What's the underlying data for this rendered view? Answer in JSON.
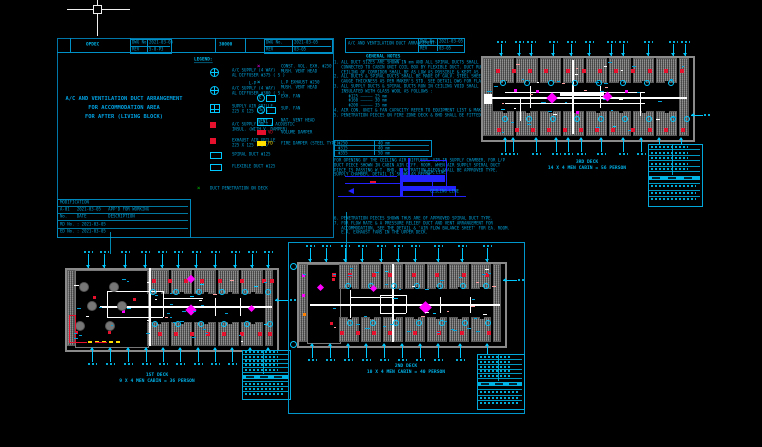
{
  "app": {
    "cursor": {
      "x": 97,
      "y": 9
    }
  },
  "colors": {
    "background": "#000000",
    "cyan_text": "#00A0D8",
    "cyan_marker": "#00C8FF",
    "red": "#E8112D",
    "magenta": "#FF00FF",
    "orange": "#FF8000",
    "green": "#00C800",
    "yellow": "#FFE000",
    "blue_detail": "#2222FF",
    "wall_gray": "#7E7E7E",
    "duct_white": "#FFFFFF"
  },
  "sheet1": {
    "header": {
      "org_label": "OPDEC",
      "code": "30000",
      "t1": {
        "dwg_label": "DWG No.",
        "dwg_value": "2021-03-05",
        "rev_label": "REV",
        "rev_value": "5-0-P3"
      },
      "t2": {
        "dwg_label": "DWG No.",
        "dwg_value": "2021-03-05",
        "rev_label": "REV",
        "rev_value": "03-05"
      }
    },
    "title_lines": [
      "A/C AND VENTILATION DUCT ARRANGEMENT",
      "FOR ACCOMMODATION AREA",
      "FOR AFTER (LIVING BLOCK)"
    ],
    "revision": {
      "rows": [
        "MODIFICATION",
        "A-01   2021-03-05   APP'D FOR WORKING",
        "No.    DATE         DESCRIPTION",
        "RD No. : 2021-03-05",
        "ED No. : 2021-03-05"
      ]
    }
  },
  "sheet2_header": {
    "title": "A/C AND VENTILATION DUCT ARRANGEMENT",
    "dwg_label": "DWG No.",
    "dwg_value": "2021-03-05",
    "rev_label": "REV",
    "rev_value": "03-05"
  },
  "legend": {
    "heading": "LEGEND:",
    "left": [
      {
        "icon": "diffuser-4way",
        "lines": [
          "A/C SUPPLY (4 WAY)",
          "AL DIFFUSER Φ375 ( S )"
        ]
      },
      {
        "icon": "diffuser-4way",
        "lines": [
          "A/C SUPPLY (4 WAY)",
          "AL DIFFUSER Φ300 ( S )"
        ]
      },
      {
        "icon": "grille",
        "lines": [
          "SUPPLY AIR GRILLE",
          "225 X 125 ( S )"
        ]
      },
      {
        "icon": "red-square",
        "lines": [
          "A/C SUPPLY DUCT / ACOUSTIC",
          "INSUL. (WITH V. DAMPER)"
        ]
      },
      {
        "icon": "red-square",
        "lines": [
          "EXHAUST AIR GRILLE",
          "225 X 125 ( E )"
        ]
      },
      {
        "icon": "duct-box",
        "lines": [
          "SPIRAL DUCT Φ125"
        ]
      },
      {
        "icon": "duct-box",
        "lines": [
          "FLEXIBLE DUCT Φ125"
        ]
      }
    ],
    "right": [
      {
        "icon": "magenta-x",
        "lines": [
          "CONST. VOL. EXH. Φ250",
          "MUSH. VENT HEAD"
        ]
      },
      {
        "icon": "cyan-x",
        "label": "L-P",
        "lines": [
          "L.P EXHAUST Φ250",
          "MUSH. VENT HEAD"
        ]
      },
      {
        "icon": "circle-e",
        "label": "E",
        "lines": [
          "EXH. FAN"
        ]
      },
      {
        "icon": "circle-s",
        "label": "S",
        "lines": [
          "SUP. FAN"
        ]
      },
      {
        "icon": "vent-box",
        "label": "VENT",
        "lines": [
          "NAT. VENT HEAD"
        ]
      },
      {
        "icon": "vd-box",
        "label": "VD",
        "lines": [
          "VOLUME DAMPER"
        ]
      },
      {
        "icon": "fd-box",
        "label": "FD",
        "lines": [
          "FIRE DAMPER (STEEL TYPE)"
        ]
      }
    ],
    "bottom": {
      "icon": "green-x",
      "lines": [
        "DUCT PENETRATION ON DECK"
      ]
    }
  },
  "notes": {
    "heading": "GENERAL NOTES",
    "lines": [
      "1. ALL DUCT SIZES ARE SHOWN IN mm AND ALL SPIRAL DUCTS SHALL BE 'Y' d",
      "   CONNECTED TO CABIN UNIT COIL BOX BY FLEXIBLE DUCT. DUCT RUN IN",
      "   CEILING OF CORRIDOR SHALL BE AS LOW AS POSSIBLE & KEPT AS SHOWN.",
      "2. ALL DUCTS & SPIRAL DUCTS SHALL BE MADE OF GALV. STEEL SHEET AND",
      "   GAUGE THICKNESS AS PER MAKER'S STD. SEE DETAIL DWG FOR FLANGE.",
      "3. ALL SUPPLY DUCTS & SPIRAL DUCTS RUN IN CEILING VOID SHALL BE",
      "   INSULATED WITH GLASS WOOL AS FOLLOWS :",
      "      Φ125 ————— 25 mm",
      "      Φ160 ————— 30 mm",
      "      Φ200 ————— 35 mm",
      "4. AIR CON. UNIT & FAN CAPACITY REFER TO EQUIPMENT LIST & MAKER DWG.",
      "5. PENETRATION PIECES ON FIRE ZONE DECK & BHD SHALL BE FITTED AS RULE."
    ],
    "size_table": [
      [
        "Φ250",
        "40 mm"
      ],
      [
        "Φ315",
        "40 mm"
      ],
      [
        "Φ355",
        "50 mm"
      ]
    ],
    "mid_lines": [
      "FOR OPENING OF THE CEILING AIR DIFFUSER, AIR IN SUPPLY CHAMBER, FOR L/P",
      "DUCT PIECE SHOWN IN CABIN AIR DIFF. ROOM. WHEN AIR SUPPLY SPIRAL DUCT",
      "PIECE IS PASSING W.T. BHD, PENETRATION PIECE SHALL BE APPROVED TYPE.",
      "SUPPLY CHAMBER, DETAIL IS SHOWN AS BELOW :"
    ],
    "end_lines": [
      "6. PENETRATION PIECES SHOWN THUS ARE OF APPROVED SPIRAL DUCT TYPE.",
      "7. FOR FLOW RATE & A PRESSURE RELIEF DUCT AND VENT ARRANGEMENT FOR",
      "   ACCOMMODATION, SEE THE DETAIL & 'AIR FLOW BALANCE SHEET' FOR EA. ROOM.",
      "   E.A. EXHAUST FANS IN THE UPPER DECK."
    ],
    "detail_labels": {
      "deck_line": "DECK LINE",
      "ceiling_line": "CEILING LINE"
    }
  },
  "detail_prims": [
    [
      "b",
      345,
      176,
      52,
      1
    ],
    [
      "b",
      345,
      183,
      58,
      1
    ],
    [
      "b",
      400,
      168,
      3,
      28
    ],
    [
      "b",
      403,
      175,
      42,
      7
    ],
    [
      "b",
      403,
      186,
      52,
      5
    ],
    [
      "b",
      338,
      196,
      128,
      1
    ],
    [
      "b",
      408,
      158,
      2,
      17
    ],
    [
      "b",
      432,
      176,
      1,
      20
    ],
    [
      "b",
      455,
      186,
      1,
      10
    ],
    [
      "b",
      420,
      160,
      26,
      1
    ],
    [
      "b",
      446,
      160,
      1,
      26
    ],
    [
      "tl",
      348,
      188
    ],
    [
      "rr",
      370,
      181,
      6,
      2
    ]
  ],
  "links": [
    [
      346,
      212,
      1,
      50
    ],
    [
      110,
      232,
      1,
      22
    ]
  ],
  "plans": [
    {
      "id": "deck3",
      "caption1": "3RD DECK",
      "caption2": "14 X 4 MEN CABIN = 56 PERSON",
      "cap_cx": 587,
      "cap_y": 159,
      "deck": {
        "x": 481,
        "y": 56,
        "w": 210,
        "h": 82,
        "end": 10,
        "mess": 0,
        "cols": 8,
        "cabH": 25
      },
      "tblock": {
        "x": 648,
        "y": 144,
        "w": 53,
        "h": 61
      },
      "frame": null,
      "call_top": {
        "y": 44,
        "len": 12,
        "xs": [
          501,
          519,
          531,
          553,
          571,
          589,
          611,
          623,
          648,
          673,
          685
        ]
      },
      "call_bot": {
        "y": 138,
        "len": 14,
        "xs": [
          505,
          513,
          536,
          556,
          568,
          581,
          601,
          623,
          641,
          659,
          681
        ]
      },
      "call_r": [
        {
          "x": 691,
          "y": 115,
          "len": 12
        }
      ],
      "red_top": {
        "y": 69,
        "xs": [
          496,
          512,
          528,
          544,
          566,
          582,
          598,
          614,
          631,
          648,
          664,
          680
        ]
      },
      "red_bot": {
        "y": 128,
        "xs": [
          497,
          515,
          531,
          547,
          563,
          579,
          595,
          611,
          631,
          648,
          664,
          681
        ]
      },
      "fans_top": {
        "y": 80,
        "xs": [
          500,
          524,
          548,
          572,
          596,
          620,
          644,
          668
        ]
      },
      "fans_bot": {
        "y": 116,
        "xs": [
          502,
          526,
          550,
          574,
          598,
          622,
          646,
          670,
          684
        ]
      },
      "magenta": [
        [
          548,
          94,
          8
        ],
        [
          604,
          93,
          7
        ]
      ],
      "dots": [
        [
          514,
          89,
          "m"
        ],
        [
          536,
          90,
          "m"
        ],
        [
          625,
          90,
          "m"
        ],
        [
          576,
          111,
          "m"
        ]
      ],
      "ducts": [
        [
          487,
          97,
          200,
          2
        ],
        [
          505,
          92,
          140,
          1
        ],
        [
          505,
          103,
          140,
          1
        ],
        [
          572,
          60,
          2,
          74
        ],
        [
          530,
          86,
          1,
          22
        ],
        [
          600,
          86,
          1,
          22
        ],
        [
          640,
          92,
          1,
          24
        ],
        [
          520,
          97,
          1,
          24
        ],
        [
          484,
          94,
          8,
          10
        ],
        [
          560,
          93,
          44,
          3
        ]
      ],
      "extras": {
        "circles": [],
        "yellow": [],
        "redrect": null,
        "reddash": [],
        "bubbles": []
      },
      "scatter": {
        "seed": 7,
        "n": 42
      }
    },
    {
      "id": "deck1",
      "caption1": "1ST DECK",
      "caption2": "9 X 4 MEN CABIN = 36 PERSON",
      "cap_cx": 157,
      "cap_y": 372,
      "deck": {
        "x": 65,
        "y": 268,
        "w": 210,
        "h": 80,
        "end": 8,
        "mess": 72,
        "cols": 5,
        "cabH": 24
      },
      "tblock": {
        "x": 242,
        "y": 350,
        "w": 47,
        "h": 48
      },
      "frame": null,
      "call_top": {
        "y": 254,
        "len": 14,
        "xs": [
          88,
          104,
          125,
          145,
          162,
          178,
          196,
          215,
          235,
          252,
          268
        ]
      },
      "call_bot": {
        "y": 348,
        "len": 14,
        "xs": [
          92,
          110,
          128,
          146,
          163,
          180,
          198,
          215,
          232,
          250,
          268
        ]
      },
      "call_r": [
        {
          "x": 275,
          "y": 300,
          "len": 14
        }
      ],
      "red_top": {
        "y": 279,
        "xs": [
          152,
          168,
          184,
          200,
          218,
          240,
          262,
          270
        ]
      },
      "red_bot": {
        "y": 332,
        "xs": [
          158,
          174,
          190,
          206,
          222,
          240,
          258,
          268
        ]
      },
      "fans_top": {
        "y": 289,
        "xs": [
          150,
          173,
          196,
          219,
          242,
          265
        ]
      },
      "fans_bot": {
        "y": 321,
        "xs": [
          152,
          175,
          198,
          221,
          244,
          267
        ]
      },
      "magenta": [
        [
          188,
          276,
          6
        ],
        [
          187,
          306,
          8
        ],
        [
          249,
          306,
          5
        ]
      ],
      "dots": [
        [
          93,
          296,
          "r"
        ],
        [
          75,
          331,
          "r"
        ],
        [
          108,
          331,
          "r"
        ],
        [
          133,
          298,
          "r"
        ],
        [
          122,
          310,
          "m"
        ]
      ],
      "ducts": [
        [
          100,
          306,
          172,
          1.5
        ],
        [
          149,
          268,
          1.5,
          78
        ],
        [
          107,
          291,
          1,
          26
        ],
        [
          163,
          291,
          1,
          26
        ],
        [
          107,
          291,
          56,
          1
        ],
        [
          107,
          317,
          56,
          1
        ],
        [
          163,
          298,
          40,
          1
        ],
        [
          215,
          298,
          1,
          18
        ],
        [
          240,
          298,
          1,
          18
        ]
      ],
      "extras": {
        "circles": [
          [
            80,
            283,
            4
          ],
          [
            110,
            283,
            4
          ],
          [
            88,
            302,
            4
          ],
          [
            118,
            302,
            4
          ],
          [
            76,
            322,
            4
          ],
          [
            106,
            322,
            4
          ]
        ],
        "yellow": [
          [
            88,
            341
          ],
          [
            95,
            341
          ],
          [
            102,
            341
          ],
          [
            109,
            341
          ],
          [
            116,
            341
          ]
        ],
        "redrect": [
          69,
          315,
          5,
          26
        ],
        "reddash": [
          [
            75,
            342,
            12
          ],
          [
            95,
            342,
            12
          ]
        ],
        "bubbles": []
      },
      "scatter": {
        "seed": 11,
        "n": 40
      }
    },
    {
      "id": "deck2",
      "caption1": "2ND DECK",
      "caption2": "10 X 4 MEN CABIN = 40 PERSON",
      "cap_cx": 406,
      "cap_y": 363,
      "deck": {
        "x": 297,
        "y": 262,
        "w": 206,
        "h": 82,
        "end": 8,
        "mess": 32,
        "cols": 7,
        "cabH": 25
      },
      "tblock": {
        "x": 477,
        "y": 354,
        "w": 46,
        "h": 54
      },
      "frame": {
        "x": 288,
        "y": 242,
        "w": 235,
        "h": 170
      },
      "call_top": {
        "y": 248,
        "len": 14,
        "xs": [
          310,
          326,
          345,
          362,
          381,
          398,
          415,
          438,
          462,
          487
        ]
      },
      "call_bot": {
        "y": 344,
        "len": 14,
        "xs": [
          312,
          330,
          348,
          366,
          384,
          402,
          420,
          438,
          460,
          487
        ]
      },
      "call_r": [
        {
          "x": 503,
          "y": 280,
          "len": 14
        }
      ],
      "red_top": {
        "y": 273,
        "xs": [
          332,
          348,
          372,
          388,
          412,
          435,
          462,
          485
        ]
      },
      "red_bot": {
        "y": 331,
        "xs": [
          340,
          356,
          372,
          388,
          413,
          437,
          460,
          487
        ]
      },
      "fans_top": {
        "y": 283,
        "xs": [
          345,
          368,
          391,
          414,
          437,
          460,
          483
        ]
      },
      "fans_bot": {
        "y": 320,
        "xs": [
          347,
          370,
          393,
          416,
          439,
          462,
          485
        ]
      },
      "magenta": [
        [
          318,
          285,
          5
        ],
        [
          371,
          286,
          5
        ],
        [
          421,
          303,
          9
        ]
      ],
      "dots": [
        [
          302,
          274,
          "m"
        ],
        [
          302,
          294,
          "m"
        ],
        [
          303,
          313,
          "o"
        ],
        [
          330,
          322,
          "r"
        ],
        [
          332,
          278,
          "r"
        ]
      ],
      "ducts": [
        [
          310,
          304,
          190,
          1.5
        ],
        [
          392,
          264,
          1.5,
          78
        ],
        [
          380,
          295,
          1,
          18
        ],
        [
          406,
          295,
          1,
          18
        ],
        [
          380,
          295,
          26,
          1
        ],
        [
          380,
          313,
          26,
          1
        ],
        [
          350,
          290,
          1,
          28
        ],
        [
          350,
          297,
          44,
          1
        ],
        [
          440,
          297,
          1,
          16
        ],
        [
          470,
          297,
          1,
          16
        ]
      ],
      "extras": {
        "circles": [],
        "yellow": [],
        "redrect": null,
        "reddash": [],
        "bubbles": [
          [
            290,
            263
          ],
          [
            290,
            341
          ]
        ]
      },
      "scatter": {
        "seed": 5,
        "n": 40
      }
    }
  ]
}
